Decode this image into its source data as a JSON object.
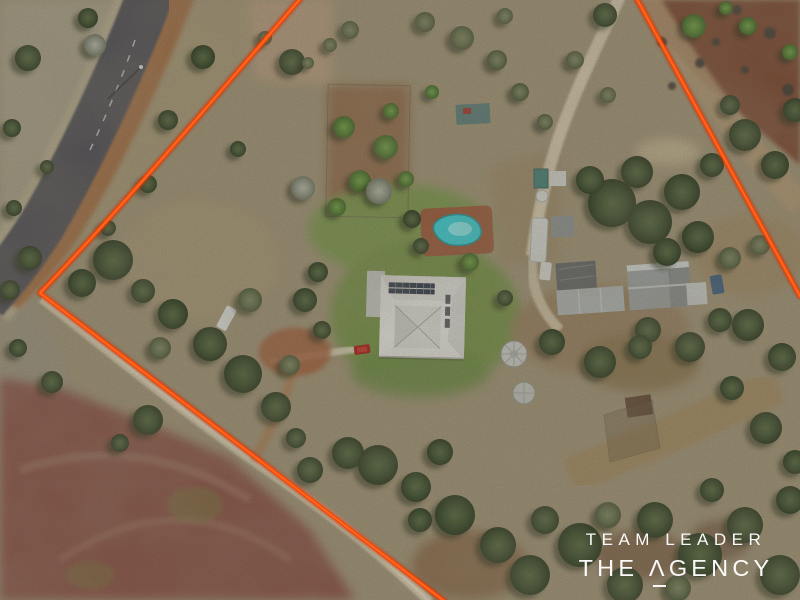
{
  "watermark": {
    "line1": "TEAM LEADER",
    "line2": "THE ΛGENCY"
  },
  "colors": {
    "boundary_line": "#f84708",
    "pool_water": "#3cccd2",
    "pool_paving": "#9a5a3c",
    "house_roof": "#e4e5e0",
    "solar_panels": "#333e4c",
    "lawn_green": "#76964d",
    "road_asphalt": "#515158",
    "gravel_shoulder": "#a06a40",
    "dirt_track": "#d6cbb0",
    "red_paddock": "#8a544a",
    "orchard_soil": "#7c4c36",
    "scrub_base": "#a09478",
    "watermark_text": "#ffffff"
  },
  "scene": {
    "features": [
      "sealed road",
      "orange property boundary overlay",
      "house with solar panels and hip roof",
      "kidney-shaped swimming pool with brick paving",
      "fenced garden orchard plot",
      "machinery sheds",
      "caravan",
      "round water tanks",
      "red car",
      "white utility vehicles",
      "dirt driveways and tracks",
      "red-brown ploughed paddock with wheel arcs",
      "bushland tree cover",
      "mulched orchard rows with shrubs"
    ]
  }
}
